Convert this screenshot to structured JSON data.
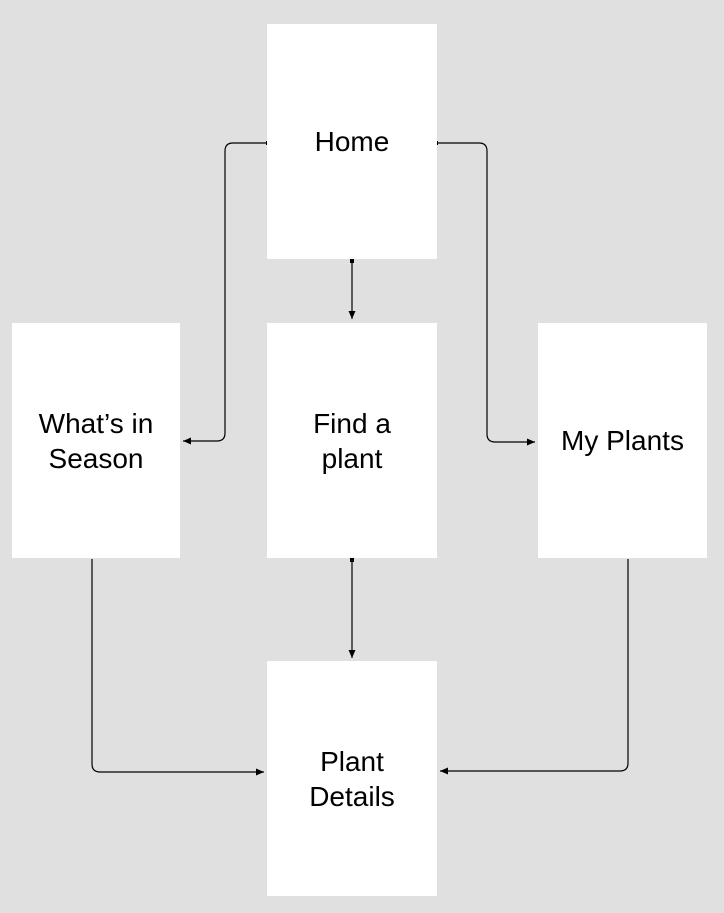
{
  "diagram": {
    "background_color": "#e0e0e0",
    "node_fill_color": "#ffffff",
    "connector_color": "#000000",
    "text_color": "#000000",
    "nodes": {
      "home": {
        "label": "Home",
        "line1": "Home",
        "line2": ""
      },
      "whats_in_season": {
        "label": "What’s in Season",
        "line1": "What’s in",
        "line2": "Season"
      },
      "find_a_plant": {
        "label": "Find a plant",
        "line1": "Find a",
        "line2": "plant"
      },
      "my_plants": {
        "label": "My Plants",
        "line1": "My Plants",
        "line2": ""
      },
      "plant_details": {
        "label": "Plant Details",
        "line1": "Plant",
        "line2": "Details"
      }
    },
    "edges": [
      {
        "from": "Home",
        "to": "Find a plant"
      },
      {
        "from": "Home",
        "to": "What’s in Season"
      },
      {
        "from": "Home",
        "to": "My Plants"
      },
      {
        "from": "Find a plant",
        "to": "Plant Details"
      },
      {
        "from": "What’s in Season",
        "to": "Plant Details"
      },
      {
        "from": "My Plants",
        "to": "Plant Details"
      }
    ]
  }
}
